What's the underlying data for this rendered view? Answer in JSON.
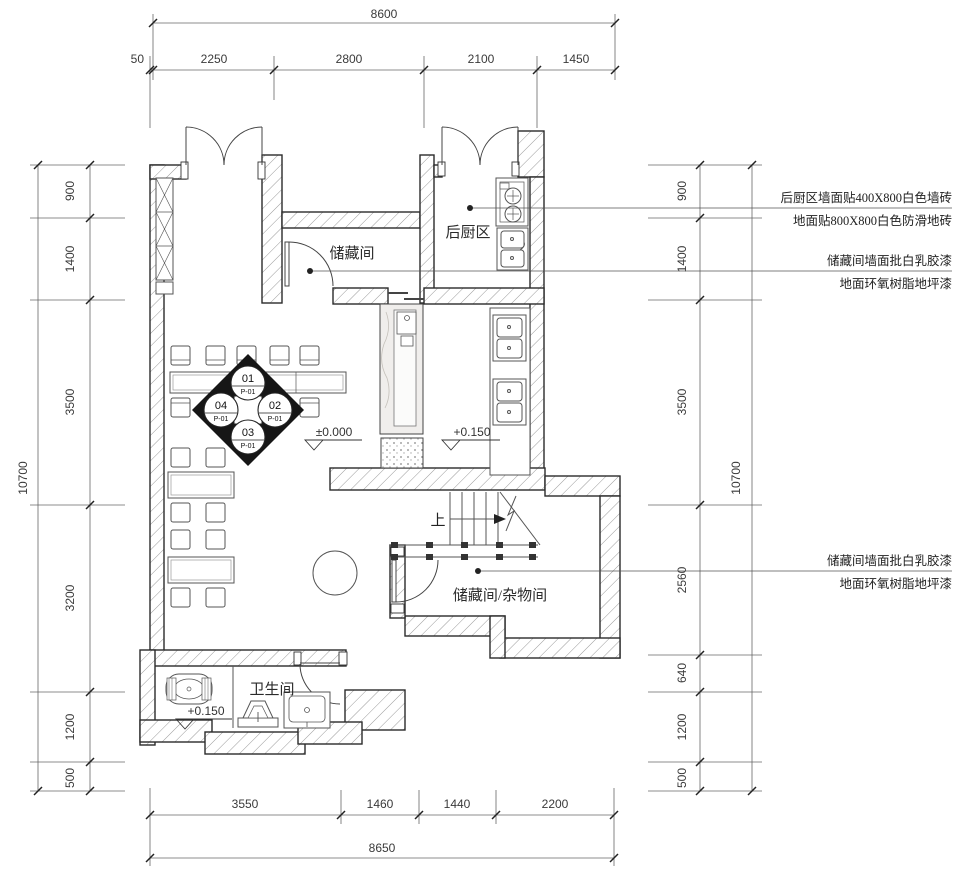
{
  "dimensions": {
    "top": {
      "total": "8600",
      "segments": [
        "50",
        "2250",
        "2800",
        "2100",
        "1450"
      ]
    },
    "bottom": {
      "total": "8650",
      "segments": [
        "3550",
        "1460",
        "1440",
        "2200"
      ]
    },
    "left": {
      "total": "10700",
      "segments": [
        "900",
        "1400",
        "3500",
        "3200",
        "1200"
      ],
      "below": "500"
    },
    "right": {
      "total": "10700",
      "segments": [
        "900",
        "1400",
        "3500",
        "2560",
        "640",
        "1200"
      ],
      "below": "500"
    }
  },
  "rooms": {
    "storage_top": "储藏间",
    "kitchen": "后厨区",
    "storage_lower": "储藏间/杂物间",
    "bathroom": "卫生间"
  },
  "levels": {
    "dining": "±0.000",
    "kitchen": "+0.150",
    "bathroom": "+0.150"
  },
  "stairs": {
    "up_label": "上"
  },
  "index_symbol": {
    "top": {
      "num": "01",
      "ref": "P-01"
    },
    "right": {
      "num": "02",
      "ref": "P-01"
    },
    "bottom": {
      "num": "03",
      "ref": "P-01"
    },
    "left": {
      "num": "04",
      "ref": "P-01"
    }
  },
  "annotations": [
    {
      "line1": "后厨区墙面贴400X800白色墙砖",
      "line2": "地面贴800X800白色防滑地砖"
    },
    {
      "line1": "储藏间墙面批白乳胶漆",
      "line2": "地面环氧树脂地坪漆"
    },
    {
      "line1": "储藏间墙面批白乳胶漆",
      "line2": "地面环氧树脂地坪漆"
    }
  ],
  "colors": {
    "line": "#2b2b2b",
    "hatch": "#9a9a9a",
    "dim": "#555555",
    "bg": "#ffffff"
  }
}
